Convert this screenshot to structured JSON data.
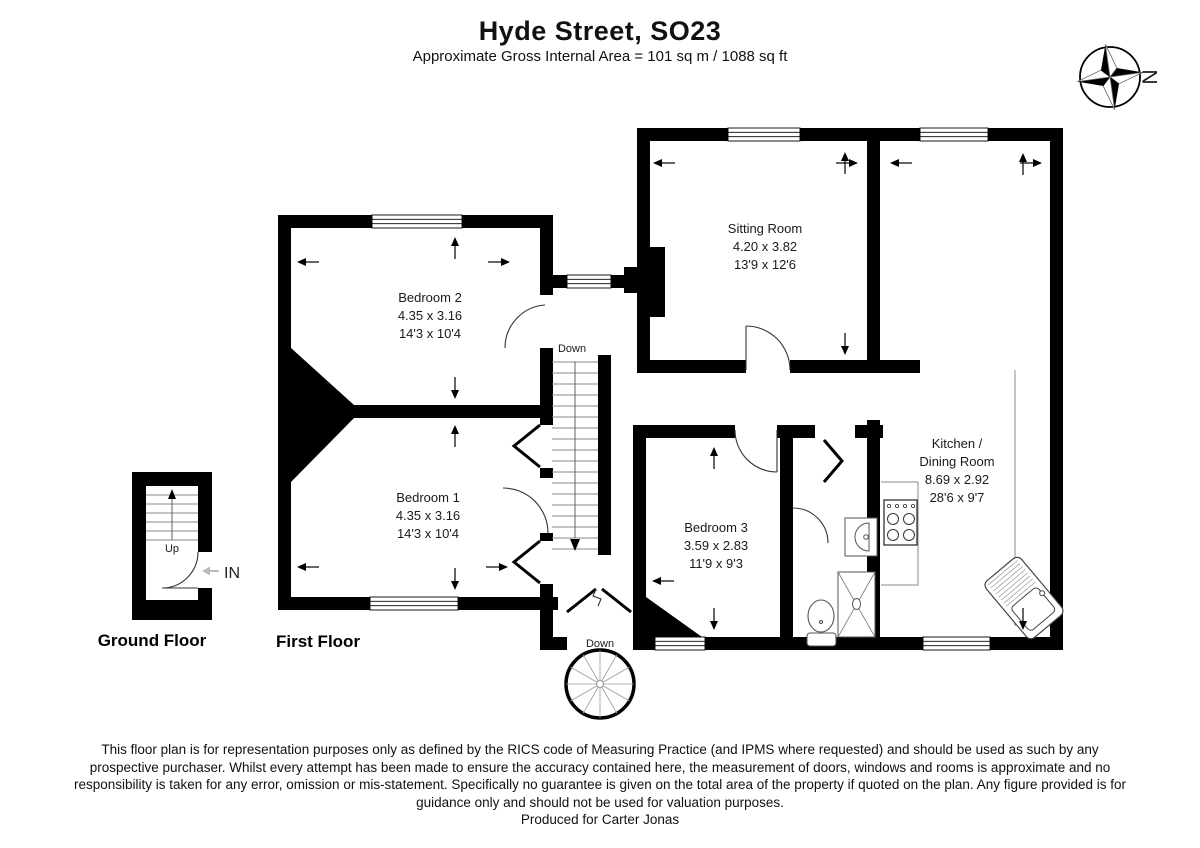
{
  "header": {
    "title": "Hyde Street, SO23",
    "subtitle": "Approximate Gross Internal Area = 101 sq m / 1088 sq ft"
  },
  "compass": {
    "north_label": "N"
  },
  "floors": {
    "ground_label": "Ground Floor",
    "first_label": "First Floor"
  },
  "rooms": [
    {
      "name": "Bedroom 2",
      "metric": "4.35 x 3.16",
      "imperial": "14'3 x 10'4"
    },
    {
      "name": "Bedroom 1",
      "metric": "4.35 x 3.16",
      "imperial": "14'3 x 10'4"
    },
    {
      "name": "Sitting Room",
      "metric": "4.20 x 3.82",
      "imperial": "13'9 x 12'6"
    },
    {
      "name": "Bedroom 3",
      "metric": "3.59 x 2.83",
      "imperial": "11'9 x 9'3"
    },
    {
      "name": "Kitchen /",
      "name2": "Dining Room",
      "metric": "8.69 x 2.92",
      "imperial": "28'6 x 9'7"
    }
  ],
  "stairs": {
    "ground_up_label": "Up",
    "first_down_label": "Down",
    "entry_down_label": "Down",
    "entrance_label": "IN"
  },
  "footer": {
    "disclaimer": "This floor plan is for representation purposes only as defined by the RICS code of Measuring Practice (and IPMS where requested) and should be used as such by any prospective purchaser. Whilst every attempt has been made to ensure the accuracy contained here, the measurement of doors, windows and rooms is approximate and no responsibility is taken for any error, omission or mis-statement. Specifically no guarantee is given on the total area of the property if quoted on the plan. Any figure provided is for guidance only and should not be used for valuation purposes.",
    "producer": "Produced for Carter Jonas"
  }
}
